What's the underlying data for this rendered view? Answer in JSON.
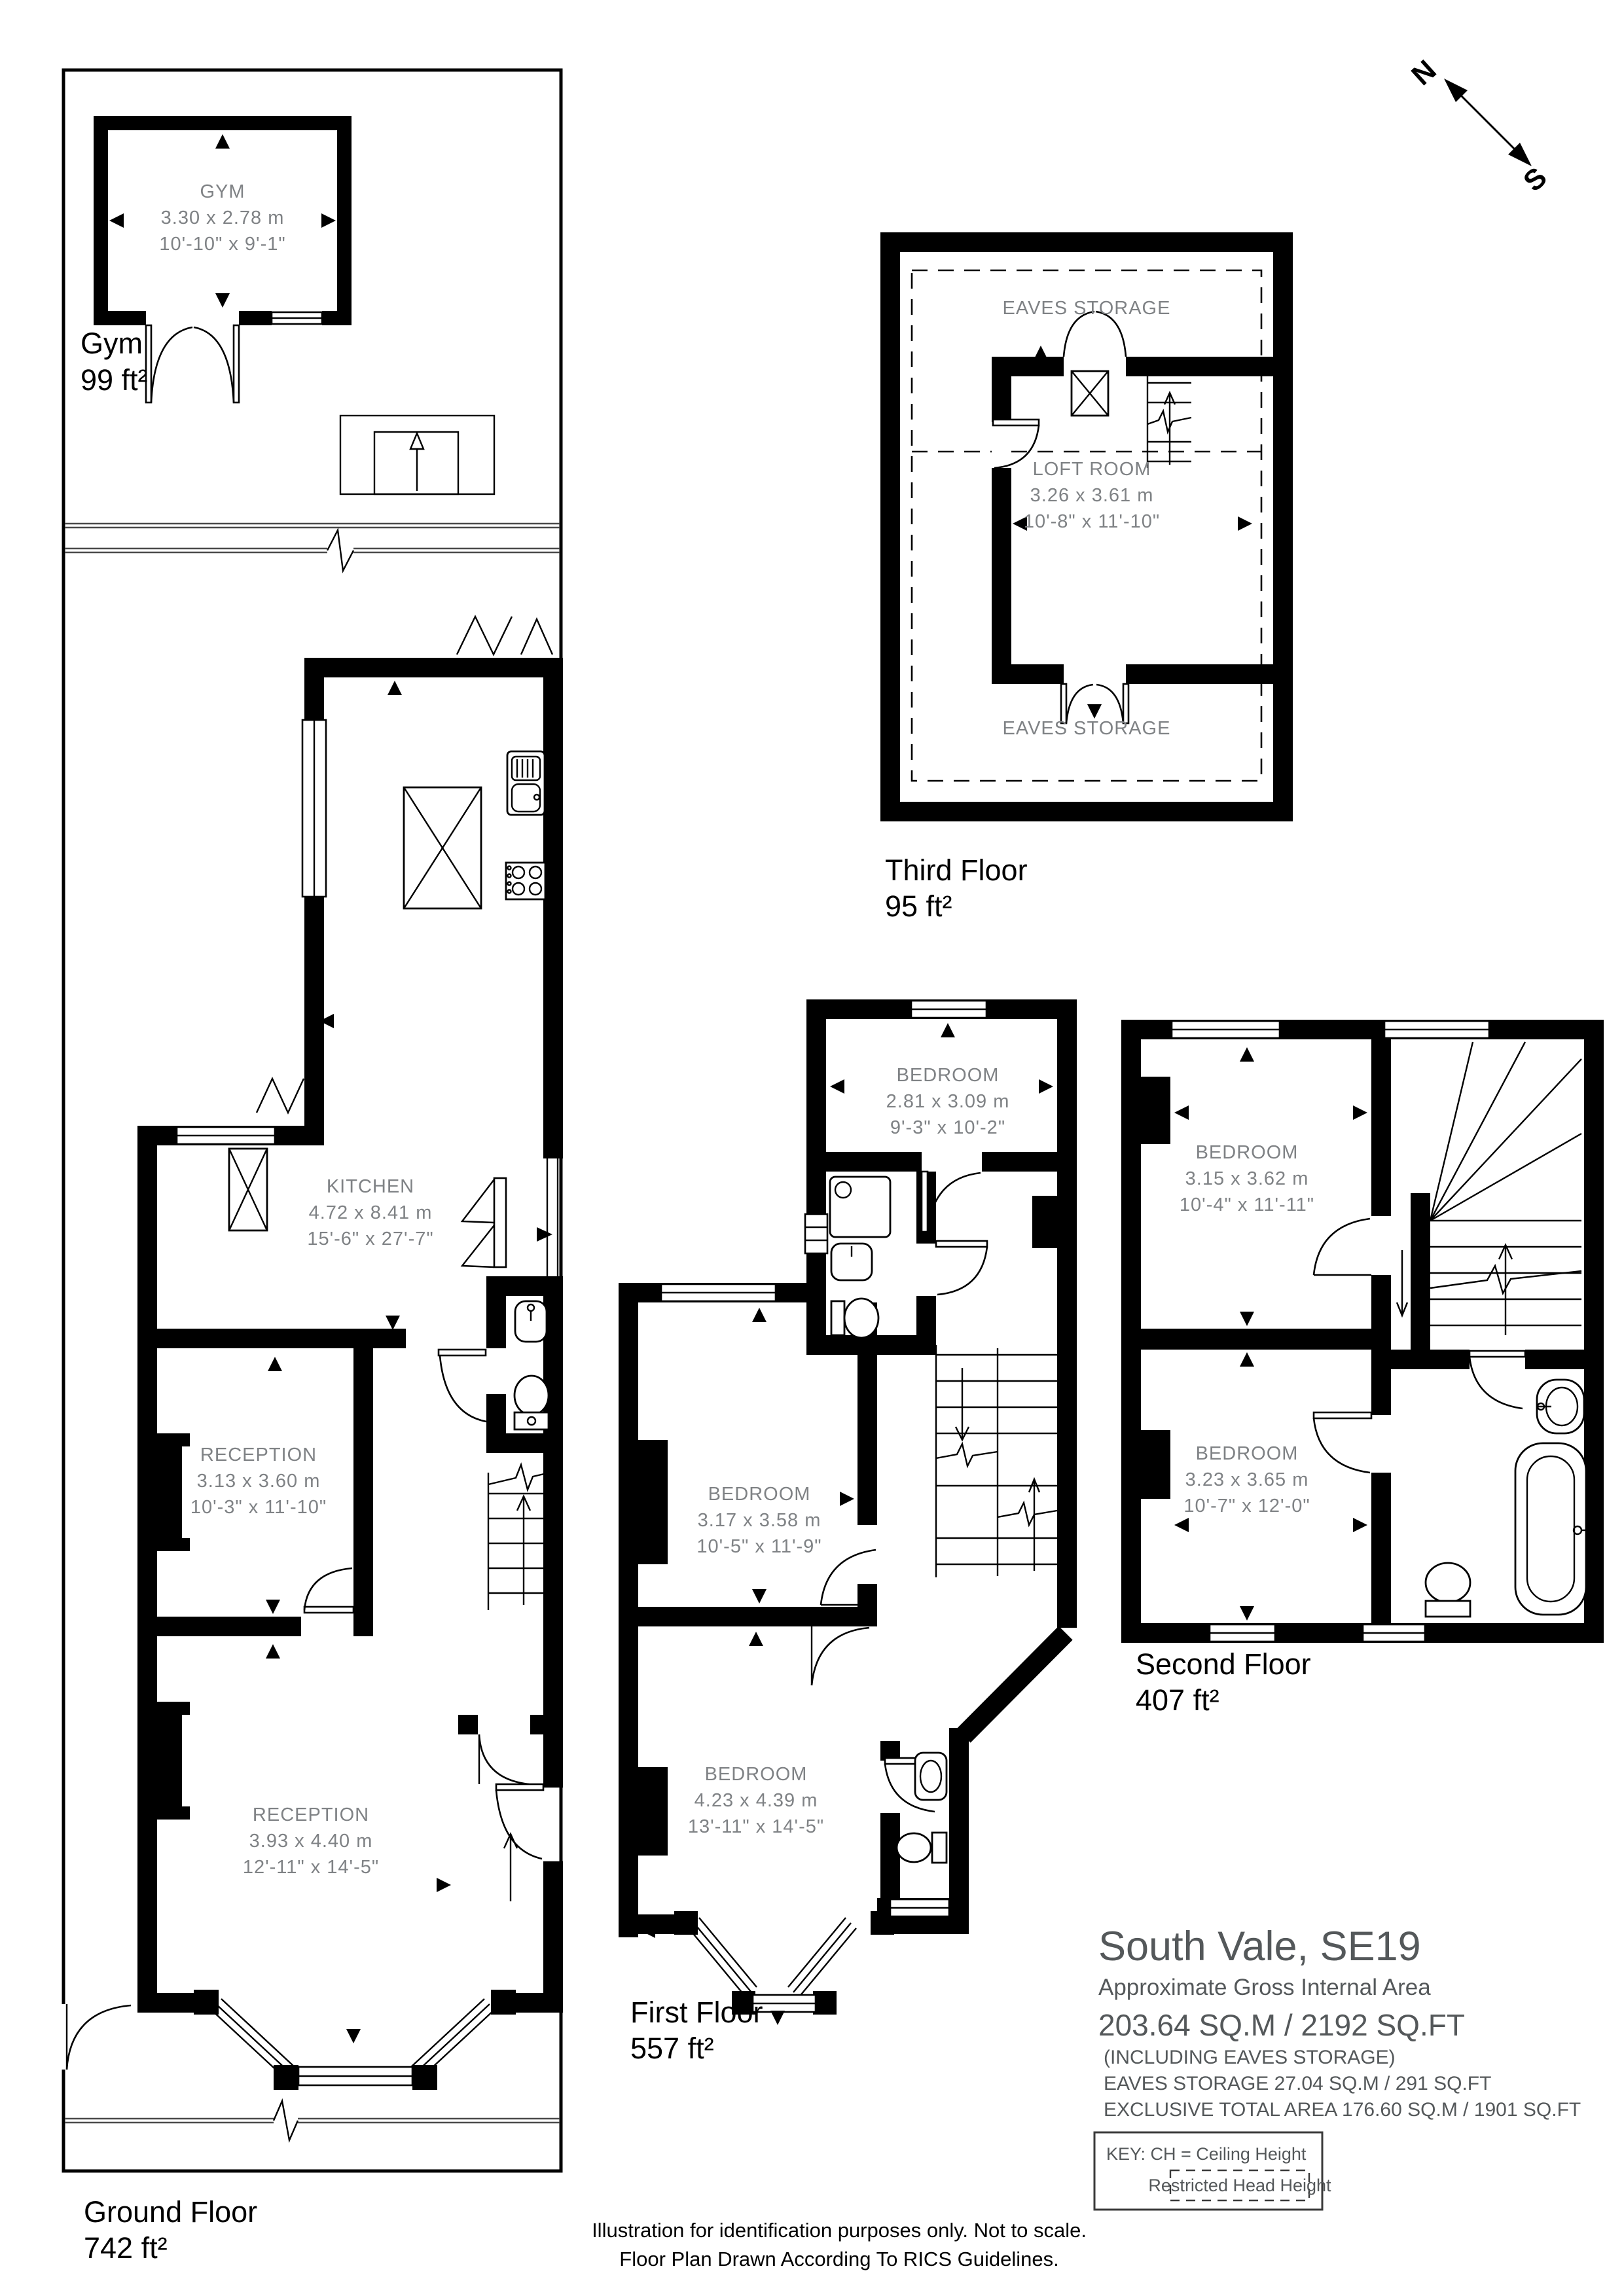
{
  "compass": {
    "north": "N",
    "south": "S"
  },
  "floors": {
    "gym": {
      "label": "Gym",
      "area": "99 ft²",
      "room": {
        "name": "GYM",
        "metric": "3.30 x 2.78 m",
        "imperial": "10'-10\" x 9'-1\""
      }
    },
    "third": {
      "label": "Third Floor",
      "area": "95 ft²",
      "eaves_top": "EAVES STORAGE",
      "eaves_bottom": "EAVES STORAGE",
      "loft": {
        "name": "LOFT ROOM",
        "metric": "3.26 x 3.61 m",
        "imperial": "10'-8\" x 11'-10\""
      }
    },
    "ground": {
      "label": "Ground Floor",
      "area": "742 ft²",
      "kitchen": {
        "name": "KITCHEN",
        "metric": "4.72 x 8.41 m",
        "imperial": "15'-6\" x 27'-7\""
      },
      "reception1": {
        "name": "RECEPTION",
        "metric": "3.13 x 3.60 m",
        "imperial": "10'-3\" x 11'-10\""
      },
      "reception2": {
        "name": "RECEPTION",
        "metric": "3.93 x 4.40 m",
        "imperial": "12'-11\" x 14'-5\""
      }
    },
    "first": {
      "label": "First Floor",
      "area": "557 ft²",
      "bedroom_rear": {
        "name": "BEDROOM",
        "metric": "2.81 x 3.09 m",
        "imperial": "9'-3\" x 10'-2\""
      },
      "bedroom_middle": {
        "name": "BEDROOM",
        "metric": "3.17 x 3.58 m",
        "imperial": "10'-5\" x 11'-9\""
      },
      "bedroom_front": {
        "name": "BEDROOM",
        "metric": "4.23 x 4.39 m",
        "imperial": "13'-11\" x 14'-5\""
      }
    },
    "second": {
      "label": "Second Floor",
      "area": "407 ft²",
      "bedroom_rear": {
        "name": "BEDROOM",
        "metric": "3.15 x 3.62 m",
        "imperial": "10'-4\" x 11'-11\""
      },
      "bedroom_front": {
        "name": "BEDROOM",
        "metric": "3.23 x 3.65 m",
        "imperial": "10'-7\" x 12'-0\""
      }
    }
  },
  "title_block": {
    "title": "South Vale, SE19",
    "subtitle": "Approximate Gross Internal Area",
    "area_line": "203.64 SQ.M / 2192 SQ.FT",
    "including_line": "(INCLUDING EAVES STORAGE)",
    "eaves_line": "EAVES STORAGE  27.04 SQ.M / 291 SQ.FT",
    "exclusive_line": "EXCLUSIVE TOTAL AREA 176.60 SQ.M / 1901 SQ.FT"
  },
  "key_box": {
    "key_line": "KEY: CH = Ceiling Height",
    "restricted": "Restricted Head Height"
  },
  "footer": {
    "line1": "Illustration for identification purposes only. Not to scale.",
    "line2": "Floor Plan Drawn According To RICS Guidelines."
  },
  "colors": {
    "wall": "#000000",
    "room_text": "#7f8285",
    "title_text": "#54585a",
    "background": "#ffffff"
  }
}
